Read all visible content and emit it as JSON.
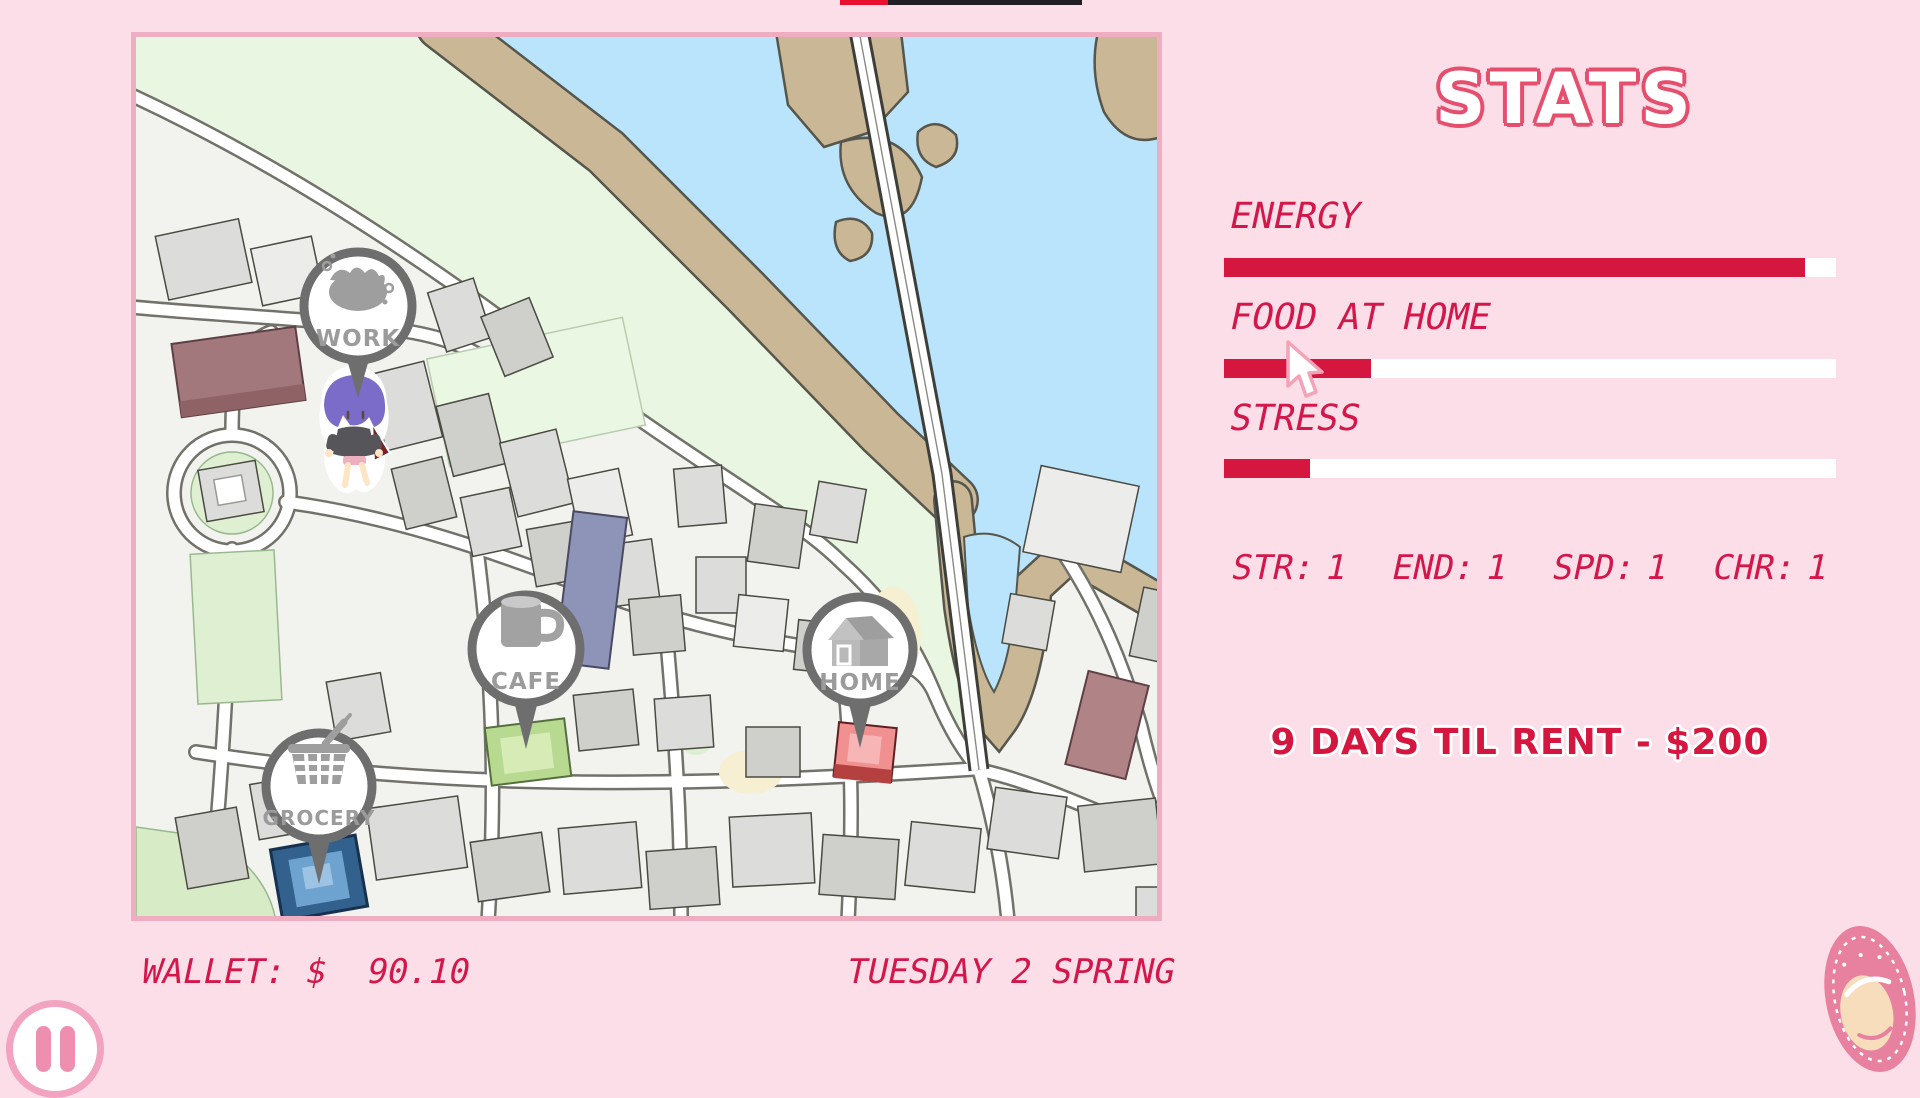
{
  "theme": {
    "background": "#fcdee8",
    "accent_red": "#d5163f",
    "lcd_red": "#d4174a",
    "map_border_pink": "#eeadc0",
    "marker_ring_gray": "#6e6e6e",
    "pause_pink": "#ee8fb0",
    "top_progress_red": "#ea1130",
    "top_progress_dark": "#221f24"
  },
  "map": {
    "markers": [
      {
        "id": "work",
        "label": "WORK"
      },
      {
        "id": "cafe",
        "label": "CAFE"
      },
      {
        "id": "grocery",
        "label": "GROCERY"
      },
      {
        "id": "home",
        "label": "HOME"
      }
    ]
  },
  "stats": {
    "title": "STATS",
    "bars": [
      {
        "label": "ENERGY",
        "percent": 95
      },
      {
        "label": "FOOD AT HOME",
        "percent": 24
      },
      {
        "label": "STRESS",
        "percent": 14
      }
    ],
    "attributes": [
      {
        "label": "STR:",
        "value": "1"
      },
      {
        "label": "END:",
        "value": "1"
      },
      {
        "label": "SPD:",
        "value": "1"
      },
      {
        "label": "CHR:",
        "value": "1"
      }
    ],
    "rent": "9 DAYS TIL RENT - $200"
  },
  "hud": {
    "wallet": "WALLET: $  90.10",
    "date": "TUESDAY 2 SPRING"
  }
}
